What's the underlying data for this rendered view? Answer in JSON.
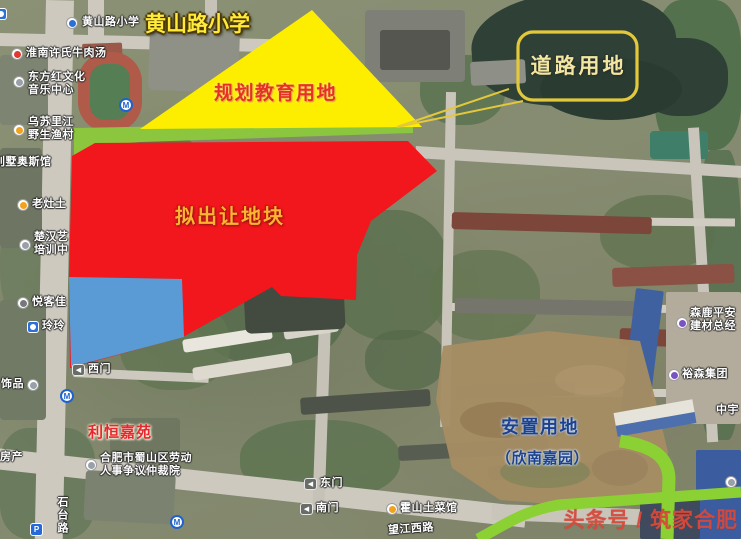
{
  "overlays": {
    "school_title": "黄山路小学",
    "education_zone": "规划教育用地",
    "road_land": "道路用地",
    "parcel": "拟出让地块",
    "resettlement_line1": "安置用地",
    "resettlement_line2": "（欣南嘉园）"
  },
  "watermark": "头条号 / 筑家合肥",
  "colors": {
    "education_fill": "#fdee00",
    "green_buffer": "#8cc63f",
    "parcel_fill": "#f2161d",
    "blue_parcel_fill": "#5b9bd5",
    "callout_stroke": "#e3c83c",
    "road_green": "#8bd133",
    "education_text": "#e63226",
    "parcel_text": "#ffb332",
    "resettlement_text": "#1e418f",
    "school_title_text": "#ffe93a",
    "estate_text": "#e8262d",
    "watermark_text": "#d8493a"
  },
  "map_labels": [
    {
      "text": "黄山路小学",
      "x": 82,
      "y": 16
    },
    {
      "text": "淮南许氏牛肉汤",
      "x": 26,
      "y": 47
    },
    {
      "text": "东方红文化\n音乐中心",
      "x": 28,
      "y": 71
    },
    {
      "text": "乌苏里江\n野生渔村",
      "x": 28,
      "y": 116
    },
    {
      "text": "别墅奥斯馆",
      "x": -6,
      "y": 156
    },
    {
      "text": "老灶土",
      "x": 32,
      "y": 198
    },
    {
      "text": "楚汉艺\n培训中",
      "x": 34,
      "y": 231
    },
    {
      "text": "悦客佳",
      "x": 32,
      "y": 296
    },
    {
      "text": "玲玲",
      "x": 42,
      "y": 320
    },
    {
      "text": "饰品",
      "x": 1,
      "y": 378
    },
    {
      "text": "西门",
      "x": 88,
      "y": 363
    },
    {
      "text": "利恒嘉苑",
      "x": 88,
      "y": 426,
      "cls": "estate"
    },
    {
      "text": "房产",
      "x": 0,
      "y": 451
    },
    {
      "text": "合肥市蜀山区劳动\n人事争议仲裁院",
      "x": 100,
      "y": 452
    },
    {
      "text": "石台路",
      "x": 55,
      "y": 496,
      "cls": "vert"
    },
    {
      "text": "东门",
      "x": 320,
      "y": 477
    },
    {
      "text": "南门",
      "x": 316,
      "y": 502
    },
    {
      "text": "霍山土菜馆",
      "x": 400,
      "y": 502
    },
    {
      "text": "望江西路",
      "x": 388,
      "y": 523,
      "rot": -4
    },
    {
      "text": "森鹿平安\n建材总经",
      "x": 690,
      "y": 307
    },
    {
      "text": "裕森集团",
      "x": 682,
      "y": 368
    },
    {
      "text": "中宇",
      "x": 716,
      "y": 404
    }
  ],
  "map_icons": [
    {
      "type": "poi-bluesq",
      "x": -5,
      "y": 8
    },
    {
      "type": "poi-blue",
      "x": 66,
      "y": 17
    },
    {
      "type": "poi-red",
      "x": 11,
      "y": 48
    },
    {
      "type": "poi-white",
      "x": 13,
      "y": 76
    },
    {
      "type": "metro",
      "x": 119,
      "y": 98
    },
    {
      "type": "poi-yellow",
      "x": 13,
      "y": 124
    },
    {
      "type": "poi-yellow",
      "x": 17,
      "y": 199
    },
    {
      "type": "poi-white",
      "x": 19,
      "y": 239
    },
    {
      "type": "poi-gray",
      "x": 17,
      "y": 297
    },
    {
      "type": "poi-bluesq",
      "x": 27,
      "y": 321
    },
    {
      "type": "poi-white",
      "x": 27,
      "y": 379
    },
    {
      "type": "gate",
      "x": 72,
      "y": 364
    },
    {
      "type": "metro",
      "x": 60,
      "y": 389
    },
    {
      "type": "poi-white",
      "x": 85,
      "y": 459
    },
    {
      "type": "parking",
      "x": 30,
      "y": 523
    },
    {
      "type": "metro",
      "x": 170,
      "y": 515
    },
    {
      "type": "gate",
      "x": 304,
      "y": 478
    },
    {
      "type": "gate",
      "x": 300,
      "y": 503
    },
    {
      "type": "poi-yellow",
      "x": 386,
      "y": 503
    },
    {
      "type": "poi-purple",
      "x": 676,
      "y": 317
    },
    {
      "type": "poi-purple",
      "x": 668,
      "y": 369
    },
    {
      "type": "poi-white",
      "x": 725,
      "y": 476
    }
  ]
}
